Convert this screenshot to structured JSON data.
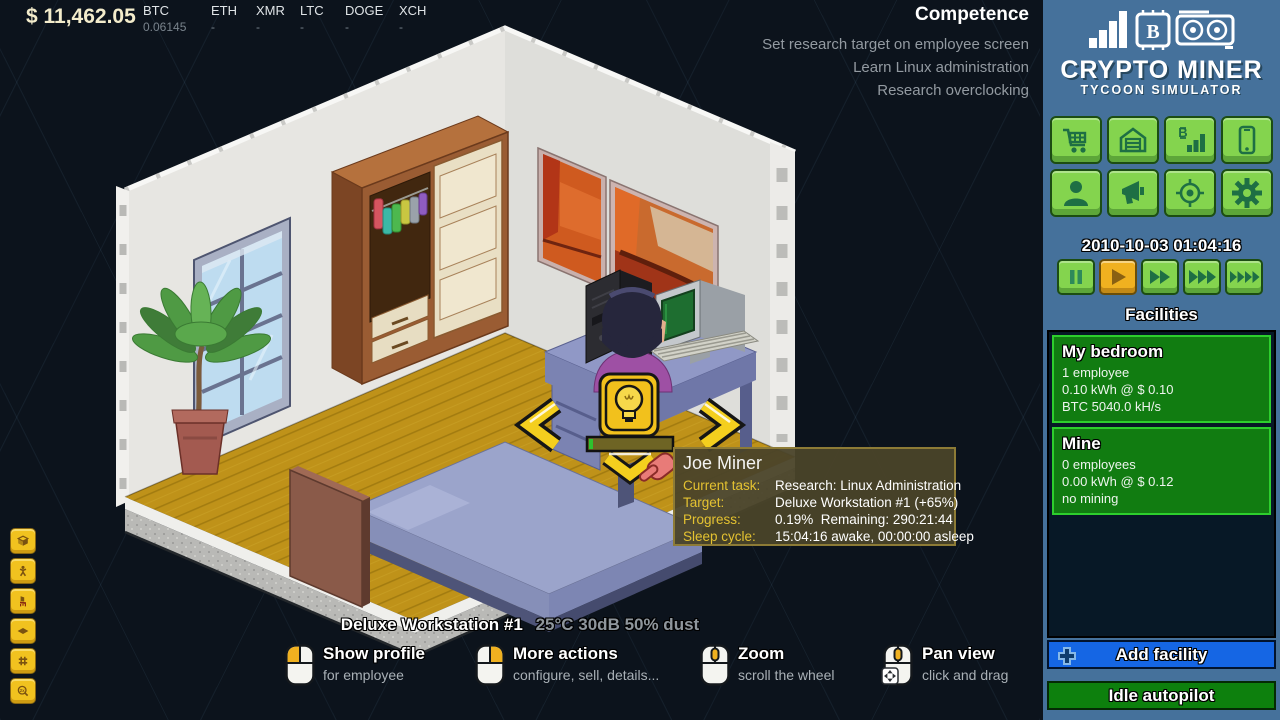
{
  "hud": {
    "money": "$ 11,462.05",
    "tickers": [
      {
        "symbol": "BTC",
        "value": "0.06145"
      },
      {
        "symbol": "ETH",
        "value": "-"
      },
      {
        "symbol": "XMR",
        "value": "-"
      },
      {
        "symbol": "LTC",
        "value": "-"
      },
      {
        "symbol": "DOGE",
        "value": "-"
      },
      {
        "symbol": "XCH",
        "value": "-"
      }
    ],
    "objectives": {
      "title": "Competence",
      "lines": [
        "Set research target on employee screen",
        "Learn Linux administration",
        "Research overclocking"
      ]
    },
    "status": {
      "name": "Deluxe Workstation #1",
      "metrics": "25°C 30dB 50% dust"
    },
    "hints": [
      {
        "title": "Show profile",
        "subtitle": "for employee",
        "mouse": "left-click"
      },
      {
        "title": "More actions",
        "subtitle": "configure, sell, details...",
        "mouse": "right-click"
      },
      {
        "title": "Zoom",
        "subtitle": "scroll the wheel",
        "mouse": "wheel"
      },
      {
        "title": "Pan view",
        "subtitle": "click and drag",
        "mouse": "wheel-drag"
      }
    ],
    "left_toolbar": {
      "tools": [
        "iso-view",
        "walk-mode",
        "furniture",
        "floor-tile",
        "grid",
        "zoom-2x"
      ],
      "zoom_label": "2x"
    }
  },
  "tooltip": {
    "name": "Joe Miner",
    "rows": [
      {
        "label": "Current task:",
        "value": "Research: Linux Administration"
      },
      {
        "label": "Target:",
        "value": "Deluxe Workstation #1 (+65%)"
      },
      {
        "label": "Progress:",
        "value": "0.19%  Remaining: 290:21:44"
      },
      {
        "label": "Sleep cycle:",
        "value": "15:04:16 awake, 00:00:00 asleep"
      }
    ]
  },
  "scene": {
    "selected_object": "Deluxe Workstation #1",
    "employee": "Joe Miner",
    "research_progress_percent": 0.19,
    "overlays": [
      "rotate-left-arrow",
      "rotate-right-arrow",
      "down-chevron",
      "research-bulb",
      "progress-bar",
      "hand-cursor"
    ]
  },
  "sidebar": {
    "logo": {
      "title": "CRYPTO MINER",
      "subtitle": "TYCOON SIMULATOR",
      "chip_letter": "B"
    },
    "nav_buttons": [
      "shop",
      "garage",
      "mining-stats",
      "phone",
      "employees",
      "marketing",
      "targets",
      "settings"
    ],
    "datetime": "2010-10-03 01:04:16",
    "speed_controls": [
      "pause",
      "play",
      "fast",
      "faster",
      "fastest"
    ],
    "active_speed": "play",
    "facilities": {
      "title": "Facilities",
      "items": [
        {
          "name": "My bedroom",
          "line1": "1 employee",
          "line2": "0.10 kWh @ $ 0.10",
          "line3": "BTC 5040.0 kH/s"
        },
        {
          "name": "Mine",
          "line1": "0 employees",
          "line2": "0.00 kWh @ $ 0.12",
          "line3": "no mining"
        }
      ]
    },
    "add_facility_label": "Add facility",
    "idle_autopilot_label": "Idle autopilot",
    "mining_chart_letter": "B"
  },
  "colors": {
    "background": "#0c131c",
    "sidebar": "#45719b",
    "button_green": "#84d44e",
    "facility_green": "#117c11",
    "accent_yellow": "#f2c31d",
    "accent_gold": "#f0b120",
    "add_blue": "#1566e4",
    "floor": "#bf9219"
  }
}
